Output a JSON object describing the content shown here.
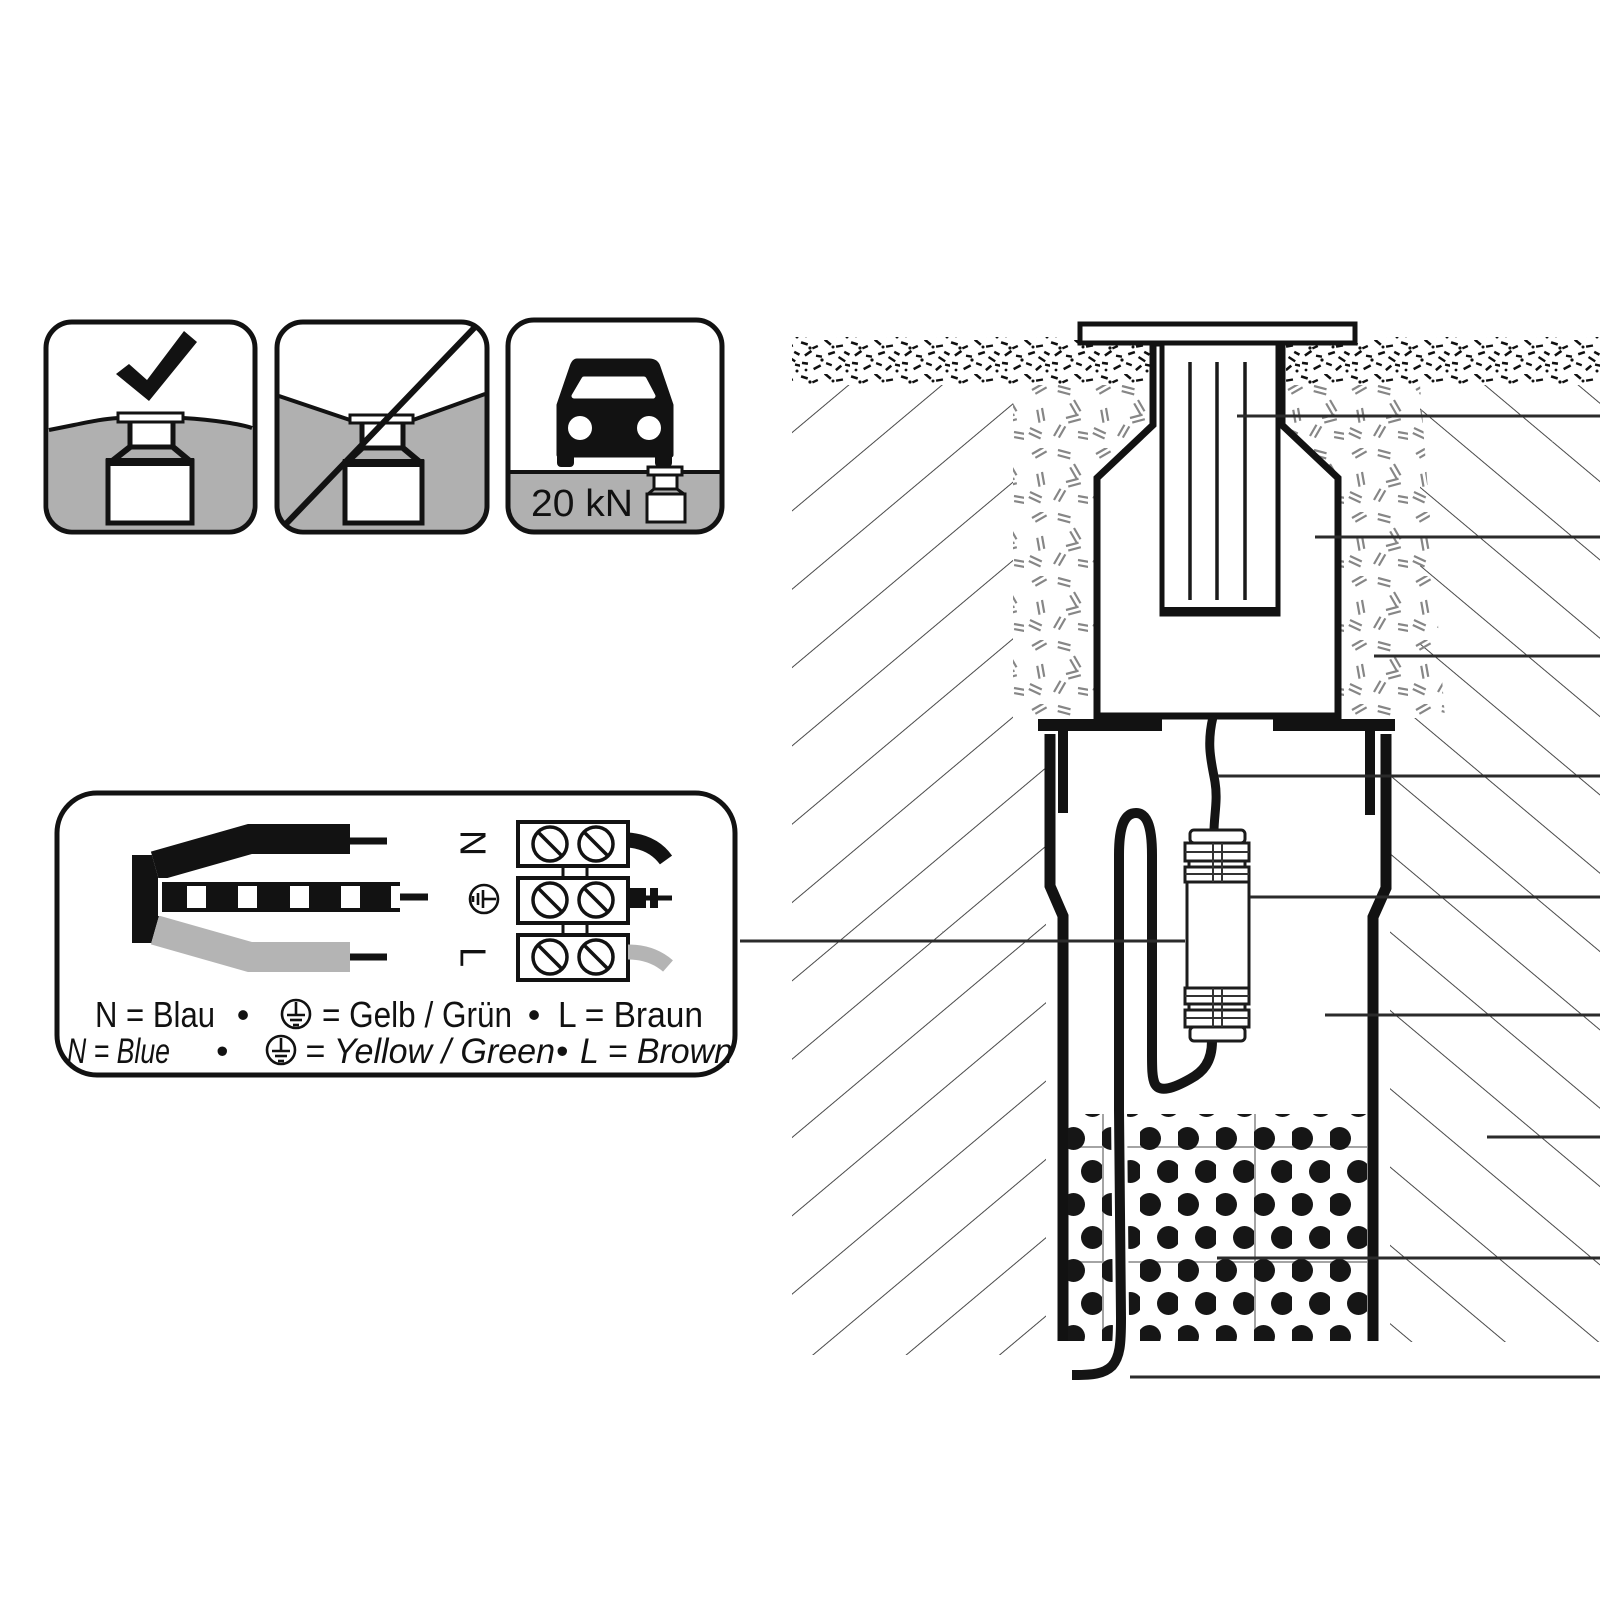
{
  "icons": {
    "approved": {
      "meaning": "correct flush installation",
      "symbol": "checkmark"
    },
    "prohibited": {
      "meaning": "do not install protruding",
      "symbol": "diagonal-slash"
    },
    "load_rating": {
      "label": "20 kN",
      "symbol": "car"
    }
  },
  "wiring_box": {
    "terminals": {
      "n": "N",
      "earth": "earth-ground-symbol",
      "l": "L"
    },
    "legend_de": {
      "p1": "N = Blau",
      "b1": "•",
      "p2": "= Gelb / Grün",
      "b2": "•",
      "p3": "L = Braun"
    },
    "legend_en": {
      "p1": "N = Blue",
      "b1": "•",
      "p2": "= Yellow / Green",
      "b2": "•",
      "p3": "L = Brown"
    }
  },
  "colors": {
    "ink": "#121212",
    "gray_fill": "#b0b0b0",
    "hatch_line": "#4a4a4a",
    "bedding_mark": "#868686"
  }
}
